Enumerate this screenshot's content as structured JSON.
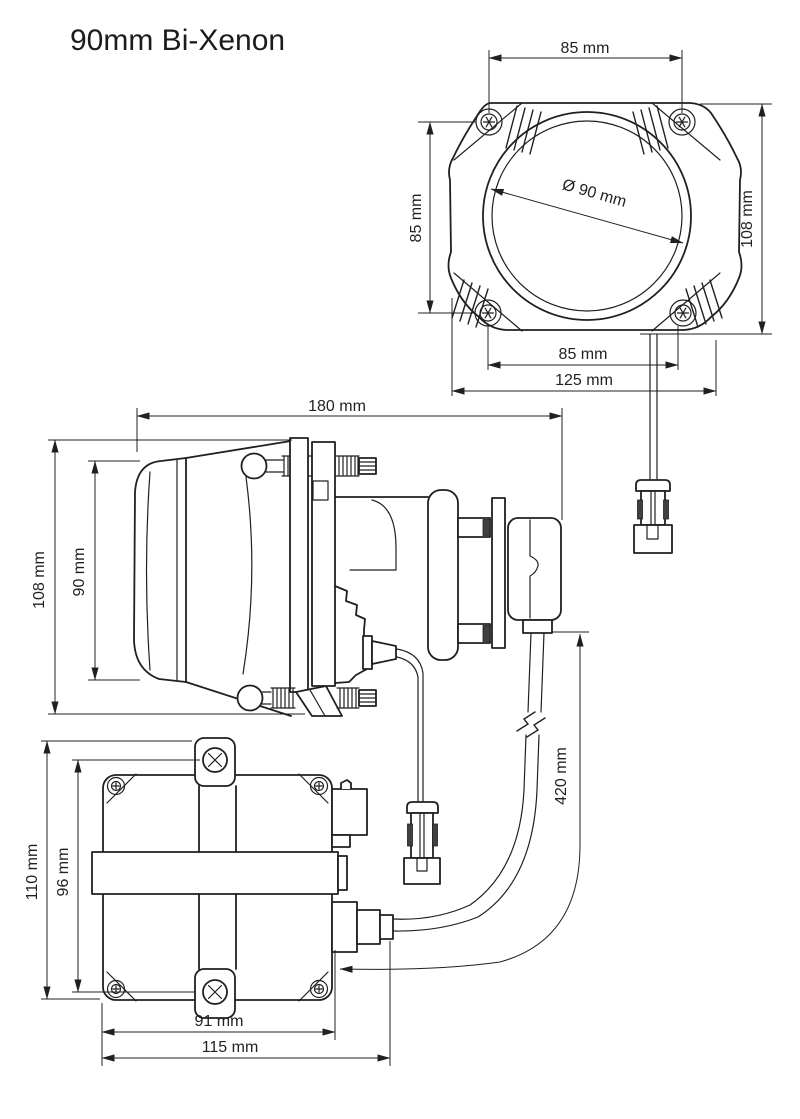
{
  "title": "90mm Bi-Xenon",
  "colors": {
    "ink": "#231f20",
    "paper": "#ffffff"
  },
  "front_view": {
    "dim_mount_width_top": "85 mm",
    "dim_mount_height": "85 mm",
    "dim_lens_diameter": "Ø 90 mm",
    "dim_height": "108 mm",
    "dim_mount_width_bottom": "85 mm",
    "dim_width": "125 mm"
  },
  "side_view": {
    "dim_depth": "180 mm",
    "dim_height": "108 mm",
    "dim_lens_height": "90 mm",
    "dim_cable_length": "420 mm"
  },
  "ballast_view": {
    "dim_height": "110 mm",
    "dim_screw_spacing": "96 mm",
    "dim_width": "91 mm",
    "dim_overall_width": "115 mm"
  }
}
